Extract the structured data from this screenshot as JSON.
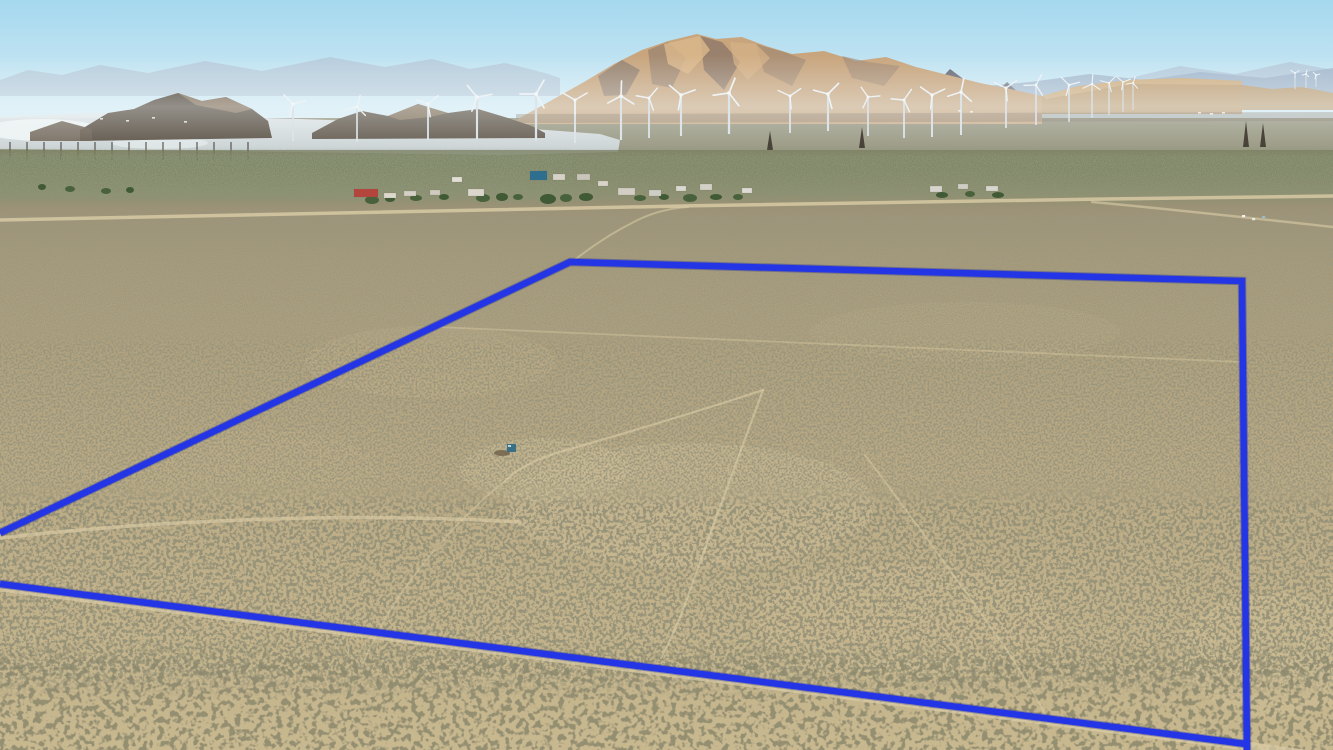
{
  "scene": {
    "description": "aerial-drone-photo-desert-parcel",
    "palette": {
      "boundary_blue": "#2435e6",
      "boundary_under": "#18239b",
      "dirt_road": "#dbcda6",
      "sky_top": "#a5d8ee",
      "sky_horizon": "#edf6f6",
      "mountain_tan": "#c8a57d",
      "butte_dark": "#463a2c",
      "lake_silver": "#d8dee0",
      "ground_far": "#8e8a73",
      "ground_near": "#c8b88f",
      "shrub_dark": "#4c4a33",
      "turbine_white": "#eef3f5"
    },
    "boundary": {
      "color": "#2435e6",
      "under_color": "#18239b",
      "width": 6.5,
      "outline_d": "M0,533 L570,262 L1242,281 L1247,750",
      "bottom_d": "M0,584 L1246,744"
    },
    "roads": [
      {
        "d": "M0,220 C300,213 650,206 980,201 C1100,199 1250,197 1333,196",
        "w": 3.5,
        "o": 0.8
      },
      {
        "d": "M1092,202 C1170,209 1260,219 1333,227",
        "w": 2.5,
        "o": 0.6
      },
      {
        "d": "M572,262 C592,246 616,230 642,218 C658,211 672,208 688,207",
        "w": 2,
        "o": 0.55
      },
      {
        "d": "M437,327 L1242,362",
        "w": 1.8,
        "o": 0.4
      },
      {
        "d": "M0,538 C140,522 340,511 520,522",
        "w": 3.5,
        "o": 0.65
      },
      {
        "d": "M763,390 C718,405 636,430 560,452 C530,461 514,472 505,481",
        "w": 2.2,
        "o": 0.6
      },
      {
        "d": "M505,481 C468,510 428,554 398,598 C382,622 370,646 362,666",
        "w": 2,
        "o": 0.45
      },
      {
        "d": "M763,390 C745,440 712,528 690,590 C680,620 668,645 661,658",
        "w": 2.2,
        "o": 0.6
      },
      {
        "d": "M865,455 C905,508 950,570 1000,640 C1016,664 1034,692 1046,716",
        "w": 2,
        "o": 0.5
      },
      {
        "d": "M0,587 L1246,746 L1333,758",
        "w": 9,
        "o": 0.7
      }
    ],
    "turbines": [
      {
        "x": 293,
        "h": 104,
        "b": 141,
        "r": 13,
        "a": 15
      },
      {
        "x": 357,
        "h": 107,
        "b": 142,
        "r": 12,
        "a": 75
      },
      {
        "x": 428,
        "h": 104,
        "b": 140,
        "r": 13,
        "a": 40
      },
      {
        "x": 477,
        "h": 97,
        "b": 139,
        "r": 15,
        "a": 10
      },
      {
        "x": 536,
        "h": 94,
        "b": 141,
        "r": 16,
        "a": 60
      },
      {
        "x": 575,
        "h": 100,
        "b": 143,
        "r": 14,
        "a": 30
      },
      {
        "x": 621,
        "h": 96,
        "b": 140,
        "r": 15,
        "a": 88
      },
      {
        "x": 649,
        "h": 98,
        "b": 138,
        "r": 13,
        "a": 50
      },
      {
        "x": 681,
        "h": 95,
        "b": 136,
        "r": 15,
        "a": 20
      },
      {
        "x": 729,
        "h": 93,
        "b": 134,
        "r": 16,
        "a": 68
      },
      {
        "x": 790,
        "h": 96,
        "b": 133,
        "r": 13,
        "a": 35
      },
      {
        "x": 828,
        "h": 94,
        "b": 131,
        "r": 15,
        "a": 45
      },
      {
        "x": 868,
        "h": 97,
        "b": 136,
        "r": 12,
        "a": 5
      },
      {
        "x": 904,
        "h": 100,
        "b": 138,
        "r": 13,
        "a": 55
      },
      {
        "x": 932,
        "h": 95,
        "b": 137,
        "r": 14,
        "a": 25
      },
      {
        "x": 961,
        "h": 92,
        "b": 135,
        "r": 14,
        "a": 78
      },
      {
        "x": 1006,
        "h": 88,
        "b": 128,
        "r": 13,
        "a": 35
      },
      {
        "x": 1036,
        "h": 85,
        "b": 125,
        "r": 12,
        "a": 62
      },
      {
        "x": 1069,
        "h": 85,
        "b": 122,
        "r": 11,
        "a": 15
      },
      {
        "x": 1092,
        "h": 84,
        "b": 118,
        "r": 10,
        "a": 85
      },
      {
        "x": 1109,
        "h": 83,
        "b": 115,
        "r": 9,
        "a": 45
      },
      {
        "x": 1123,
        "h": 82,
        "b": 112,
        "r": 8,
        "a": 20
      },
      {
        "x": 1133,
        "h": 83,
        "b": 110,
        "r": 7,
        "a": 70
      },
      {
        "x": 1295,
        "h": 73,
        "b": 89,
        "r": 5,
        "a": 30
      },
      {
        "x": 1306,
        "h": 74,
        "b": 88,
        "r": 4,
        "a": 75
      },
      {
        "x": 1316,
        "h": 75,
        "b": 87,
        "r": 4,
        "a": 15
      }
    ],
    "power_poles": {
      "y": 142,
      "h": 18,
      "xs": [
        10,
        27,
        44,
        61,
        78,
        95,
        112,
        129,
        146,
        163,
        180,
        197,
        214,
        231,
        248
      ]
    },
    "lattice_towers": [
      {
        "x": 770,
        "y": 131,
        "h": 19
      },
      {
        "x": 862,
        "y": 127,
        "h": 21
      },
      {
        "x": 1246,
        "y": 121,
        "h": 26
      },
      {
        "x": 1263,
        "y": 123,
        "h": 24
      }
    ],
    "settlement": {
      "buildings": [
        {
          "x": 354,
          "y": 189,
          "w": 24,
          "h": 8,
          "c": "#b3453c"
        },
        {
          "x": 384,
          "y": 193,
          "w": 12,
          "h": 5,
          "c": "#ded9ce"
        },
        {
          "x": 404,
          "y": 191,
          "w": 12,
          "h": 5,
          "c": "#d4d0c6"
        },
        {
          "x": 430,
          "y": 190,
          "w": 10,
          "h": 5,
          "c": "#cfcbc0"
        },
        {
          "x": 452,
          "y": 177,
          "w": 10,
          "h": 5,
          "c": "#e2dfd6"
        },
        {
          "x": 468,
          "y": 189,
          "w": 16,
          "h": 7,
          "c": "#dbd7cc"
        },
        {
          "x": 530,
          "y": 171,
          "w": 17,
          "h": 9,
          "c": "#2e6e8e"
        },
        {
          "x": 553,
          "y": 174,
          "w": 12,
          "h": 6,
          "c": "#d6d2c8"
        },
        {
          "x": 577,
          "y": 174,
          "w": 13,
          "h": 6,
          "c": "#c9c5ba"
        },
        {
          "x": 598,
          "y": 181,
          "w": 10,
          "h": 5,
          "c": "#d8d4ca"
        },
        {
          "x": 618,
          "y": 188,
          "w": 17,
          "h": 7,
          "c": "#d2cec4"
        },
        {
          "x": 649,
          "y": 190,
          "w": 12,
          "h": 6,
          "c": "#cdcfc7"
        },
        {
          "x": 676,
          "y": 186,
          "w": 10,
          "h": 5,
          "c": "#d9d9d1"
        },
        {
          "x": 700,
          "y": 184,
          "w": 12,
          "h": 6,
          "c": "#d3d1c7"
        },
        {
          "x": 742,
          "y": 188,
          "w": 10,
          "h": 5,
          "c": "#dddbd3"
        },
        {
          "x": 930,
          "y": 186,
          "w": 12,
          "h": 6,
          "c": "#d6d4cc"
        },
        {
          "x": 958,
          "y": 184,
          "w": 10,
          "h": 5,
          "c": "#cfcdc5"
        },
        {
          "x": 986,
          "y": 186,
          "w": 12,
          "h": 5,
          "c": "#d8d6ce"
        }
      ],
      "trees": [
        {
          "x": 372,
          "y": 200,
          "rx": 7,
          "ry": 4
        },
        {
          "x": 390,
          "y": 199,
          "rx": 5,
          "ry": 3
        },
        {
          "x": 416,
          "y": 198,
          "rx": 6,
          "ry": 3
        },
        {
          "x": 444,
          "y": 197,
          "rx": 5,
          "ry": 3
        },
        {
          "x": 483,
          "y": 198,
          "rx": 7,
          "ry": 4
        },
        {
          "x": 502,
          "y": 197,
          "rx": 6,
          "ry": 4
        },
        {
          "x": 518,
          "y": 197,
          "rx": 5,
          "ry": 3
        },
        {
          "x": 548,
          "y": 199,
          "rx": 8,
          "ry": 5
        },
        {
          "x": 566,
          "y": 198,
          "rx": 6,
          "ry": 4
        },
        {
          "x": 586,
          "y": 197,
          "rx": 7,
          "ry": 4
        },
        {
          "x": 640,
          "y": 198,
          "rx": 6,
          "ry": 3
        },
        {
          "x": 664,
          "y": 197,
          "rx": 5,
          "ry": 3
        },
        {
          "x": 690,
          "y": 198,
          "rx": 7,
          "ry": 4
        },
        {
          "x": 716,
          "y": 197,
          "rx": 6,
          "ry": 3
        },
        {
          "x": 738,
          "y": 197,
          "rx": 5,
          "ry": 3
        },
        {
          "x": 942,
          "y": 195,
          "rx": 6,
          "ry": 3
        },
        {
          "x": 970,
          "y": 194,
          "rx": 5,
          "ry": 3
        },
        {
          "x": 998,
          "y": 195,
          "rx": 6,
          "ry": 3
        },
        {
          "x": 70,
          "y": 189,
          "rx": 5,
          "ry": 3
        },
        {
          "x": 42,
          "y": 187,
          "rx": 4,
          "ry": 3
        },
        {
          "x": 106,
          "y": 191,
          "rx": 5,
          "ry": 3
        },
        {
          "x": 130,
          "y": 190,
          "rx": 4,
          "ry": 3
        }
      ]
    },
    "parcel_structure": {
      "x": 507,
      "y": 444,
      "w": 9,
      "h": 8,
      "color": "#3a7086",
      "shadow": {
        "x": 502,
        "y": 453,
        "rx": 8,
        "ry": 3,
        "color": "#6e5f48"
      }
    },
    "vehicles": [
      {
        "x": 1242,
        "y": 215,
        "c": "#f2f2ee"
      },
      {
        "x": 1252,
        "y": 218,
        "c": "#e8e8e2"
      },
      {
        "x": 1262,
        "y": 216,
        "c": "#9fb9c9"
      }
    ],
    "distant_specks": [
      {
        "x": 100,
        "y": 118
      },
      {
        "x": 126,
        "y": 120
      },
      {
        "x": 152,
        "y": 117
      },
      {
        "x": 184,
        "y": 121
      },
      {
        "x": 74,
        "y": 122
      },
      {
        "x": 958,
        "y": 110
      },
      {
        "x": 970,
        "y": 111
      },
      {
        "x": 1198,
        "y": 112
      },
      {
        "x": 1210,
        "y": 113
      },
      {
        "x": 1222,
        "y": 112
      }
    ]
  }
}
